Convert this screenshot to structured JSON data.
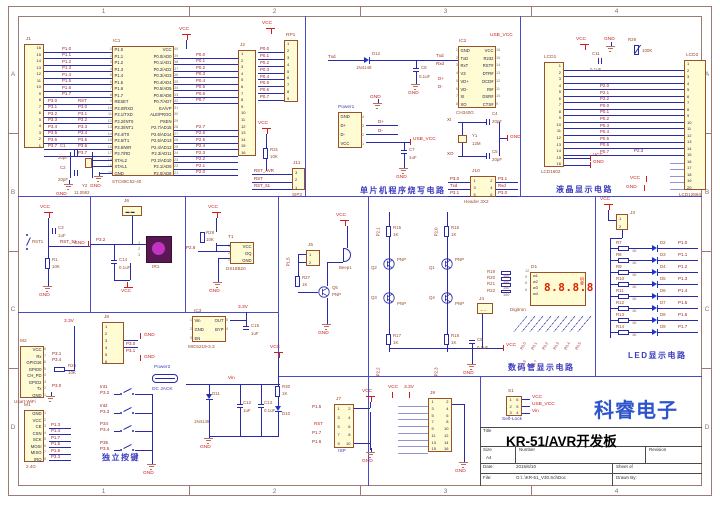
{
  "zones": {
    "cols": [
      "1",
      "2",
      "3",
      "4"
    ],
    "rows": [
      "A",
      "B",
      "C",
      "D"
    ]
  },
  "pw": {
    "vcc": "VCC",
    "gnd": "GND",
    "usb": "USB_VCC",
    "v33": "3.3V",
    "vin": "Vin",
    "rst": "RST"
  },
  "sections": {
    "prog": "单片机程序烧写电路",
    "lcd": "液晶显示电路",
    "digitron": "数码管显示电路",
    "led": "LED显示电路",
    "keys": "独立按键"
  },
  "brand": "科睿电子",
  "titleblock": {
    "title_label": "Title",
    "title": "KR-51/AVR开发板",
    "size_label": "Size",
    "size": "A4",
    "number_label": "Number",
    "revision_label": "Revision",
    "date_label": "Date:",
    "date": "2015/6/10",
    "file_label": "File:",
    "file": "G:\\..\\KR-51_V30.SchDoc",
    "sheet_label": "Sheet  of",
    "drawn_label": "Drawn By:"
  },
  "mcu": {
    "ref": "IC1",
    "part": "STC89C52-40",
    "rows": [
      {
        "ln": "1",
        "l": "P1.0",
        "r": "VCC",
        "rn": "40"
      },
      {
        "ln": "2",
        "l": "P1.1",
        "r": "P0.0/AD0",
        "rn": "39"
      },
      {
        "ln": "3",
        "l": "P1.2",
        "r": "P0.1/AD1",
        "rn": "38"
      },
      {
        "ln": "4",
        "l": "P1.3",
        "r": "P0.2/AD2",
        "rn": "37"
      },
      {
        "ln": "5",
        "l": "P1.4",
        "r": "P0.3/AD3",
        "rn": "36"
      },
      {
        "ln": "6",
        "l": "P1.5",
        "r": "P0.4/AD4",
        "rn": "35"
      },
      {
        "ln": "7",
        "l": "P1.6",
        "r": "P0.5/AD5",
        "rn": "34"
      },
      {
        "ln": "8",
        "l": "P1.7",
        "r": "P0.6/AD6",
        "rn": "33"
      },
      {
        "ln": "9",
        "l": "RESET",
        "r": "P0.7/AD7",
        "rn": "32"
      },
      {
        "ln": "10",
        "l": "P3.0/RXD",
        "r": "EA/VP",
        "rn": "31"
      },
      {
        "ln": "11",
        "l": "P3.1/TXD",
        "r": "ALE/PROG",
        "rn": "30"
      },
      {
        "ln": "12",
        "l": "P3.2/INT0",
        "r": "PSEN",
        "rn": "29"
      },
      {
        "ln": "13",
        "l": "P3.3/INT1",
        "r": "P2.7/AD15",
        "rn": "28"
      },
      {
        "ln": "14",
        "l": "P3.4/T0",
        "r": "P2.6/AD14",
        "rn": "27"
      },
      {
        "ln": "15",
        "l": "P3.5/T1",
        "r": "P2.5/AD13",
        "rn": "26"
      },
      {
        "ln": "16",
        "l": "P3.6/WR",
        "r": "P2.4/AD12",
        "rn": "25"
      },
      {
        "ln": "17",
        "l": "P3.7/RD",
        "r": "P2.3/AD11",
        "rn": "24"
      },
      {
        "ln": "18",
        "l": "XTAL2",
        "r": "P2.2/AD10",
        "rn": "23"
      },
      {
        "ln": "19",
        "l": "XTAL1",
        "r": "P2.1/AD9",
        "rn": "22"
      },
      {
        "ln": "20",
        "l": "GND",
        "r": "P2.0/AD8",
        "rn": "21"
      }
    ],
    "j1_ref": "J1",
    "j1_pins": [
      "16",
      "15",
      "14",
      "13",
      "12",
      "11",
      "10",
      "9",
      "8",
      "7",
      "6",
      "5",
      "4",
      "3",
      "2",
      "1"
    ],
    "j2_ref": "J2",
    "j2_pins": [
      "1",
      "2",
      "3",
      "4",
      "5",
      "6",
      "7",
      "8",
      "9",
      "10",
      "11",
      "12",
      "13",
      "14",
      "15",
      "16"
    ],
    "rp1_ref": "RP1",
    "rp1_pins": [
      "1",
      "2",
      "3",
      "4",
      "5",
      "6",
      "7",
      "8",
      "9"
    ],
    "p1_nets": [
      "P1.0",
      "P1.1",
      "P1.2",
      "P1.3",
      "P1.4",
      "P1.5",
      "P1.6",
      "P1.7"
    ],
    "p3_rows": [
      {
        "a": "P3.0",
        "b": "RST"
      },
      {
        "a": "P3.1",
        "b": "P3.0"
      },
      {
        "a": "P3.2",
        "b": "P3.1"
      },
      {
        "a": "P3.3",
        "b": "P3.2"
      },
      {
        "a": "P3.4",
        "b": "P3.3"
      },
      {
        "a": "P3.5",
        "b": "P3.4"
      },
      {
        "a": "P3.6",
        "b": "P3.5"
      },
      {
        "a": "P3.7",
        "b": "P3.6"
      },
      {
        "a": "",
        "b": "P3.7"
      }
    ],
    "p0_nets": [
      "P0.0",
      "P0.1",
      "P0.2",
      "P0.3",
      "P0.4",
      "P0.5",
      "P0.6",
      "P0.7"
    ],
    "p2_nets": [
      "P2.7",
      "P2.6",
      "P2.5",
      "P2.4",
      "P2.3",
      "P2.2",
      "P2.1",
      "P2.0"
    ],
    "rp_nets": [
      "P0.0",
      "P0.1",
      "P0.2",
      "P0.3",
      "P0.4",
      "P0.5",
      "P0.6",
      "P0.7"
    ],
    "c1": "C1",
    "c1v": "20pF",
    "c2": "C2",
    "c2v": "20pF",
    "y2": "Y2",
    "y2v": "11.0592"
  },
  "prog": {
    "txd": "Txd",
    "rxd": "Rxd",
    "d12": "D12",
    "d12v": "1N4148",
    "c8": "C8",
    "c8v": "0.1uF",
    "power1_ref": "Power1",
    "power1_rows": [
      {
        "l": "GND",
        "rn": "4"
      },
      {
        "l": "D+",
        "rn": "3"
      },
      {
        "l": "D-",
        "rn": "2"
      },
      {
        "l": "VCC",
        "rn": "1"
      }
    ],
    "dp": "D+",
    "dm": "D-",
    "c7": "C7",
    "c7v": "1uF",
    "ic2_ref": "IC2",
    "ic2_part": "CH340G",
    "ic2_rows": [
      {
        "ln": "1",
        "l": "GND",
        "r": "VCC",
        "rn": "16"
      },
      {
        "ln": "2",
        "l": "TxD",
        "r": "R232",
        "rn": "15"
      },
      {
        "ln": "3",
        "l": "RxT",
        "r": "RST#",
        "rn": "14"
      },
      {
        "ln": "4",
        "l": "V3",
        "r": "DTR#",
        "rn": "13"
      },
      {
        "ln": "5",
        "l": "VD+",
        "r": "DCD#",
        "rn": "12"
      },
      {
        "ln": "6",
        "l": "VD-",
        "r": "RI#",
        "rn": "11"
      },
      {
        "ln": "7",
        "l": "XI",
        "r": "DSR#",
        "rn": "10"
      },
      {
        "ln": "8",
        "l": "XO",
        "r": "CTS#",
        "rn": "9"
      }
    ],
    "xi": "XI",
    "xo": "XO",
    "y1": "Y1",
    "y1v": "12M",
    "c4": "C4",
    "c4v": "20pF",
    "c5": "C5",
    "c5v": "20pF",
    "j10_ref": "J10",
    "j10_part": "Header 3X2",
    "j10_rows": [
      {
        "a": "1",
        "b": "2"
      },
      {
        "a": "3",
        "b": "4"
      },
      {
        "a": "5",
        "b": "6"
      }
    ],
    "j10_left": [
      "P3.0",
      "Txd",
      "P3.1"
    ],
    "j10_right": [
      "P3.1",
      "Rxd",
      "P3.0"
    ],
    "r31": "R31",
    "r31v": "10K",
    "j11_ref": "J11",
    "j11_part": "SIP3",
    "j11_pins": [
      "3",
      "2",
      "1"
    ],
    "j11_nets": [
      "RST_AVR",
      "RST",
      "RST_51"
    ]
  },
  "lcd": {
    "c11": "C11",
    "c11v": "0.1uF",
    "r29": "R29",
    "r29v": "100K",
    "lcd1_ref": "LCD1",
    "lcd1_part": "LCD1602",
    "lcd1_pins": [
      "1",
      "2",
      "3",
      "4",
      "5",
      "6",
      "7",
      "8",
      "9",
      "10",
      "11",
      "12",
      "13",
      "14",
      "15",
      "16"
    ],
    "lcd2_ref": "LCD2",
    "lcd2_part": "LCD12864",
    "lcd2_pins": [
      "1",
      "2",
      "3",
      "4",
      "5",
      "6",
      "7",
      "8",
      "9",
      "10",
      "11",
      "12",
      "13",
      "14",
      "15",
      "16",
      "17",
      "18",
      "19",
      "20"
    ],
    "bus_rows": [
      "",
      "",
      "",
      "P2.0",
      "P2.1",
      "P2.2",
      "P0.0",
      "P0.1",
      "P0.2",
      "P0.3",
      "P0.4",
      "P0.5",
      "P0.6",
      "P0.7"
    ],
    "p23": "P2.3"
  },
  "digitron": {
    "p21": "P2.1",
    "p20": "P2.0",
    "p22": "P2.2",
    "p23": "P2.3",
    "r15": "R15",
    "r16": "R16",
    "r17": "R17",
    "r18": "R18",
    "rk": "1K",
    "q2": "Q2",
    "q1": "Q1",
    "q3": "Q3",
    "q4": "Q4",
    "pnp": "PNP",
    "rsel": [
      {
        "ref": "R19",
        "val": "100",
        "pin": "12"
      },
      {
        "ref": "R20",
        "val": "100",
        "pin": "9"
      },
      {
        "ref": "R21",
        "val": "100",
        "pin": "8"
      },
      {
        "ref": "R22",
        "val": "100",
        "pin": "6"
      }
    ],
    "d1_ref": "D1",
    "d1_part": "Digitron",
    "w": [
      "w1",
      "w2",
      "w3",
      "w4"
    ],
    "digits": "8.8.8.8",
    "side": "科睿",
    "j4": "J4",
    "c9": "C9",
    "c9v": "0.1uF",
    "seg_nets": [
      "P0.0",
      "P0.1",
      "P0.2",
      "P0.3",
      "P0.4",
      "P0.5",
      "P0.6",
      "P0.7"
    ]
  },
  "led": {
    "j3": "J3",
    "j3_pins": [
      "1",
      "2"
    ],
    "rows": [
      {
        "r": "R7",
        "v": "1K",
        "d": "D2",
        "p": "P1.0"
      },
      {
        "r": "R8",
        "v": "1K",
        "d": "D3",
        "p": "P1.1"
      },
      {
        "r": "R9",
        "v": "1K",
        "d": "D4",
        "p": "P1.2"
      },
      {
        "r": "R10",
        "v": "1K",
        "d": "D5",
        "p": "P1.3"
      },
      {
        "r": "R11",
        "v": "1K",
        "d": "D6",
        "p": "P1.4"
      },
      {
        "r": "R12",
        "v": "1K",
        "d": "D7",
        "p": "P1.5"
      },
      {
        "r": "R13",
        "v": "1K",
        "d": "D8",
        "p": "P1.6"
      },
      {
        "r": "R14",
        "v": "1K",
        "d": "D9",
        "p": "P1.7"
      }
    ]
  },
  "reset": {
    "rst1": "RST1",
    "c3": "C3",
    "c3v": "1uF",
    "net": "RST_51",
    "r1": "R1",
    "r1v": "10K"
  },
  "ir": {
    "j6": "J6",
    "p32": "P3.2",
    "ir1": "IR1",
    "c14": "C14",
    "c14v": "0.1uF",
    "pins": [
      "1",
      "2",
      "3"
    ]
  },
  "ds": {
    "r28": "R28",
    "r28v": "10K",
    "t1": "T1",
    "part": "DS18B20",
    "rows": [
      {
        "ln": "3",
        "r": "VCC"
      },
      {
        "ln": "2",
        "r": "DQ"
      },
      {
        "ln": "1",
        "r": "GND"
      }
    ],
    "p26": "P2.6"
  },
  "buzzer": {
    "p15": "P1.5",
    "j5": "J5",
    "j5_pins": [
      "1",
      "2"
    ],
    "r27": "R27",
    "r27v": "1K",
    "q5": "Q5",
    "pnp": "PNP",
    "beep": "Beep1"
  },
  "wifi": {
    "ref": "M2",
    "part": "Usart-WiFi",
    "rows": [
      {
        "r": "VCC",
        "rn": "8"
      },
      {
        "r": "Rx",
        "rn": "7"
      },
      {
        "r": "GPIO16",
        "rn": "6"
      },
      {
        "r": "GPIO0",
        "rn": "5"
      },
      {
        "r": "CH_PD",
        "rn": "4"
      },
      {
        "r": "GPIO2",
        "rn": "3"
      },
      {
        "r": "Tx",
        "rn": "2"
      },
      {
        "r": "GND",
        "rn": "1"
      }
    ],
    "rx": "P3.1",
    "g16": "P3.4",
    "tx": "P3.0",
    "r26": "R26",
    "r26v": "10K"
  },
  "nrf": {
    "ref": "M1",
    "part": "2.4G",
    "rows": [
      {
        "r": "GND",
        "rn": "1"
      },
      {
        "r": "VCC",
        "rn": "2"
      },
      {
        "r": "CE",
        "rn": "3"
      },
      {
        "r": "CSN",
        "rn": "4"
      },
      {
        "r": "SCK",
        "rn": "5"
      },
      {
        "r": "MOSI",
        "rn": "6"
      },
      {
        "r": "MISO",
        "rn": "7"
      },
      {
        "r": "IRQ",
        "rn": "8"
      }
    ],
    "nets": [
      "P1.3",
      "P1.4",
      "P1.7",
      "P1.5",
      "P1.6",
      "P3.3"
    ]
  },
  "j8": {
    "ref": "J8",
    "pins": [
      "1",
      "2",
      "3",
      "4",
      "5",
      "6"
    ],
    "p30": "P3.0",
    "p31": "P3.1"
  },
  "power2": {
    "ref": "Power2",
    "part": "DC JACK"
  },
  "reg": {
    "ref": "IC3",
    "part": "MIC5219-3.3",
    "rows": [
      {
        "ln": "1",
        "l": "Vin",
        "r": "OUT",
        "rn": "5"
      },
      {
        "ln": "2",
        "l": "GND",
        "r": "BYP",
        "rn": "4"
      },
      {
        "ln": "3",
        "l": "EN",
        "r": "",
        "rn": ""
      }
    ],
    "c15": "C15",
    "c15v": "1uF"
  },
  "psec": {
    "d11": "D11",
    "d11v": "1N4148",
    "c12": "C12",
    "c12v": "1uF",
    "c13": "C13",
    "c13v": "0.1uF",
    "d10": "D10",
    "r30": "R30",
    "r30v": "1K"
  },
  "keys": {
    "rows": [
      {
        "net": "Int1",
        "pin": "P3.2"
      },
      {
        "net": "Int2",
        "pin": "P3.3"
      },
      {
        "net": "P34",
        "pin": "P3.4"
      },
      {
        "net": "P35",
        "pin": "P3.5"
      }
    ]
  },
  "isp": {
    "ref": "J7",
    "part": "ISP",
    "rows": [
      {
        "a": "1",
        "b": "2"
      },
      {
        "a": "3",
        "b": "4"
      },
      {
        "a": "5",
        "b": "6"
      },
      {
        "a": "7",
        "b": "8"
      },
      {
        "a": "9",
        "b": "10"
      }
    ],
    "left": [
      "P1.5",
      "RST",
      "P1.7",
      "P1.6"
    ]
  },
  "j9": {
    "ref": "J9",
    "rows": [
      {
        "a": "1",
        "b": "2"
      },
      {
        "a": "3",
        "b": "4"
      },
      {
        "a": "5",
        "b": "6"
      },
      {
        "a": "7",
        "b": "8"
      },
      {
        "a": "9",
        "b": "10"
      },
      {
        "a": "11",
        "b": "12"
      },
      {
        "a": "13",
        "b": "14"
      },
      {
        "a": "15",
        "b": "16"
      }
    ],
    "vcc": "VCC",
    "v33": "3.3V"
  },
  "s1": {
    "ref": "S1",
    "part": "Self-Lock",
    "rows": [
      {
        "a": "1",
        "b": "6"
      },
      {
        "a": "2",
        "b": "5"
      },
      {
        "a": "3",
        "b": "4"
      }
    ],
    "nets": [
      "VCC",
      "USB_VCC",
      "Vin"
    ]
  }
}
